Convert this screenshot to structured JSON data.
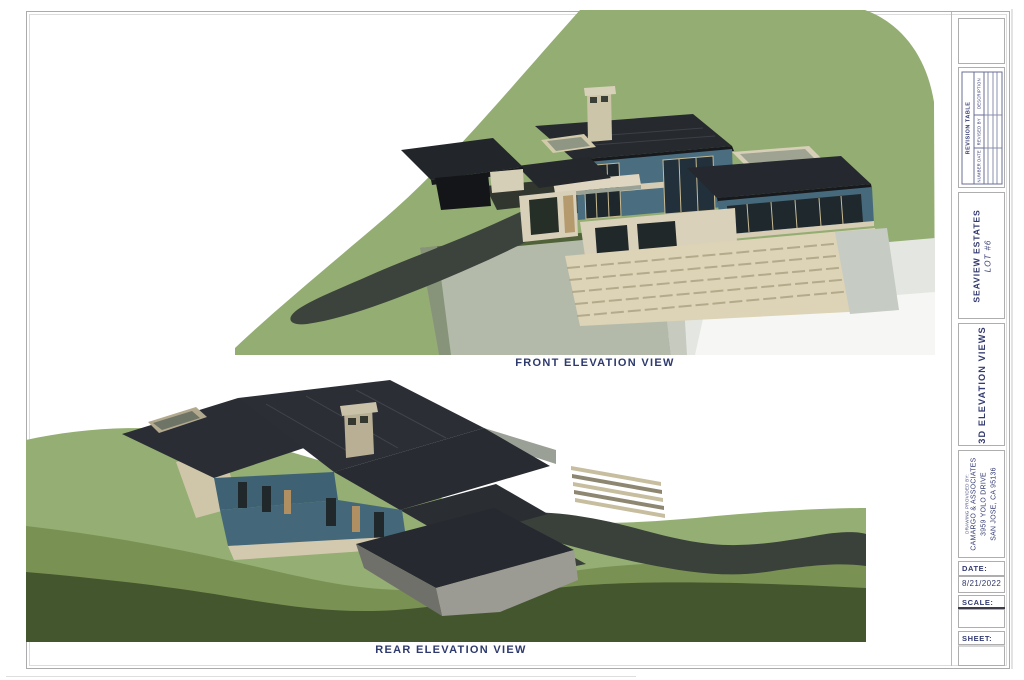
{
  "views": {
    "front": {
      "caption": "FRONT ELEVATION VIEW"
    },
    "rear": {
      "caption": "REAR ELEVATION VIEW"
    }
  },
  "title_block": {
    "revision_table": {
      "title": "REVISION TABLE",
      "columns": [
        "NUMBER DATE",
        "REVISED BY",
        "DESCRIPTION"
      ]
    },
    "project": {
      "line1": "SEAVIEW ESTATES",
      "line2": "LOT #6"
    },
    "sheet_title": "3D ELEVATION VIEWS",
    "provider": {
      "prefix": "DRAWING PROVIDED BY:",
      "name": "CAMARGO & ASSOCIATES",
      "address_line1": "3959 YOLO DRIVE",
      "address_line2": "SAN JOSE, CA 95136"
    },
    "date": {
      "label": "DATE:",
      "value": "8/21/2022"
    },
    "scale": {
      "label": "SCALE:",
      "value": ""
    },
    "sheet": {
      "label": "SHEET:",
      "value": ""
    }
  },
  "colors": {
    "label_navy": "#2e3a6e",
    "hill_green": "#93ad72",
    "hill_dark_green": "#44562e",
    "roof_charcoal": "#2a2d33",
    "wall_blue": "#476b7d",
    "wall_cream": "#d8d0b8",
    "driveway": "#3b403a",
    "cliff_gray": "#b4baa9"
  }
}
